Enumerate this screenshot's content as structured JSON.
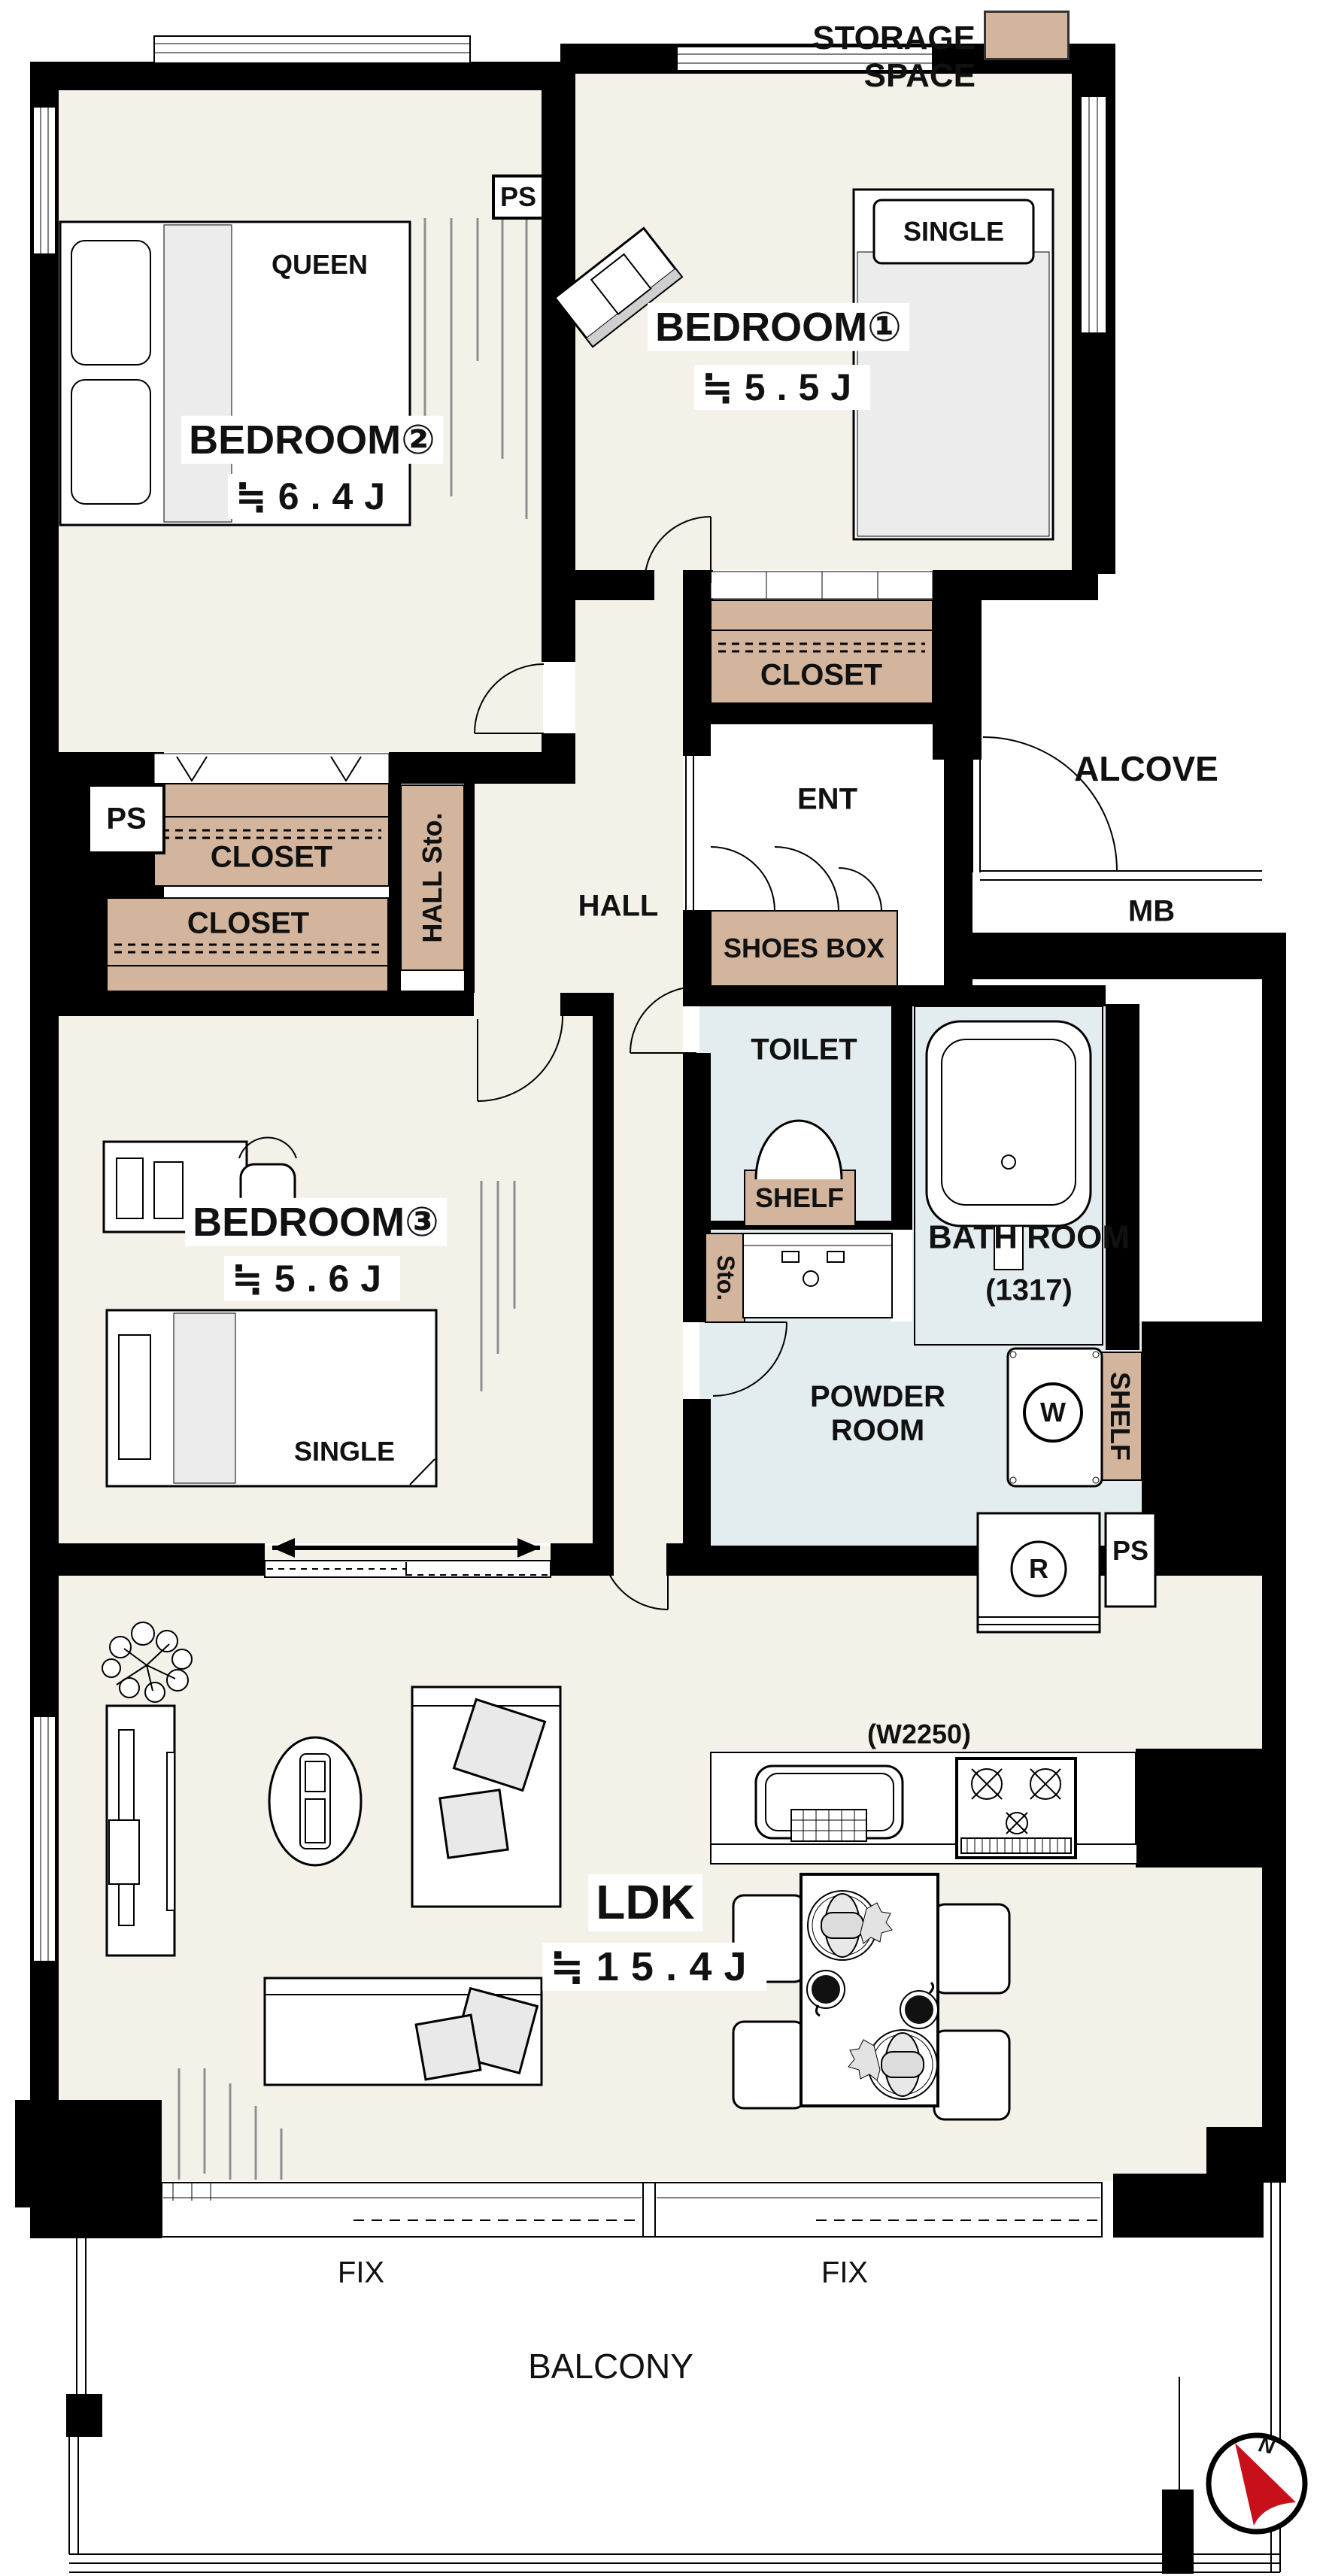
{
  "legend": {
    "label": "STORAGE SPACE",
    "swatch_color": "#d3b59d"
  },
  "rooms": {
    "bedroom1": {
      "name": "BEDROOM①",
      "size": "≒5.5J",
      "bed": "SINGLE"
    },
    "bedroom2": {
      "name": "BEDROOM②",
      "size": "≒6.4J",
      "bed": "QUEEN"
    },
    "bedroom3": {
      "name": "BEDROOM③",
      "size": "≒5.6J",
      "bed": "SINGLE"
    },
    "ldk": {
      "name": "LDK",
      "size": "≒15.4J"
    }
  },
  "labels": {
    "ps_top": "PS",
    "ps_left": "PS",
    "ps_kitchen": "PS",
    "closet_bedroom1": "CLOSET",
    "closet_hall_upper": "CLOSET",
    "closet_hall_lower": "CLOSET",
    "hall_storage": "HALL Sto.",
    "hall": "HALL",
    "entrance": "ENT",
    "alcove": "ALCOVE",
    "meter_box": "MB",
    "shoes_box": "SHOES BOX",
    "toilet": "TOILET",
    "toilet_shelf": "SHELF",
    "bathroom": "BATH ROOM",
    "bathroom_size": "(1317)",
    "storage_small": "Sto.",
    "powder_room": "POWDER\nROOM",
    "washer": "W",
    "powder_shelf": "SHELF",
    "refrigerator": "R",
    "kitchen_width": "(W2250)",
    "fix_left": "FIX",
    "fix_right": "FIX",
    "balcony": "BALCONY"
  },
  "compass": {
    "north": "N",
    "arrow_color": "#c8101b"
  },
  "colors": {
    "floor": "#f4f1e9",
    "wet_area": "#e3edef",
    "storage_tan": "#d3b59d",
    "wall": "#000000",
    "bed_grey": "#ececec"
  }
}
